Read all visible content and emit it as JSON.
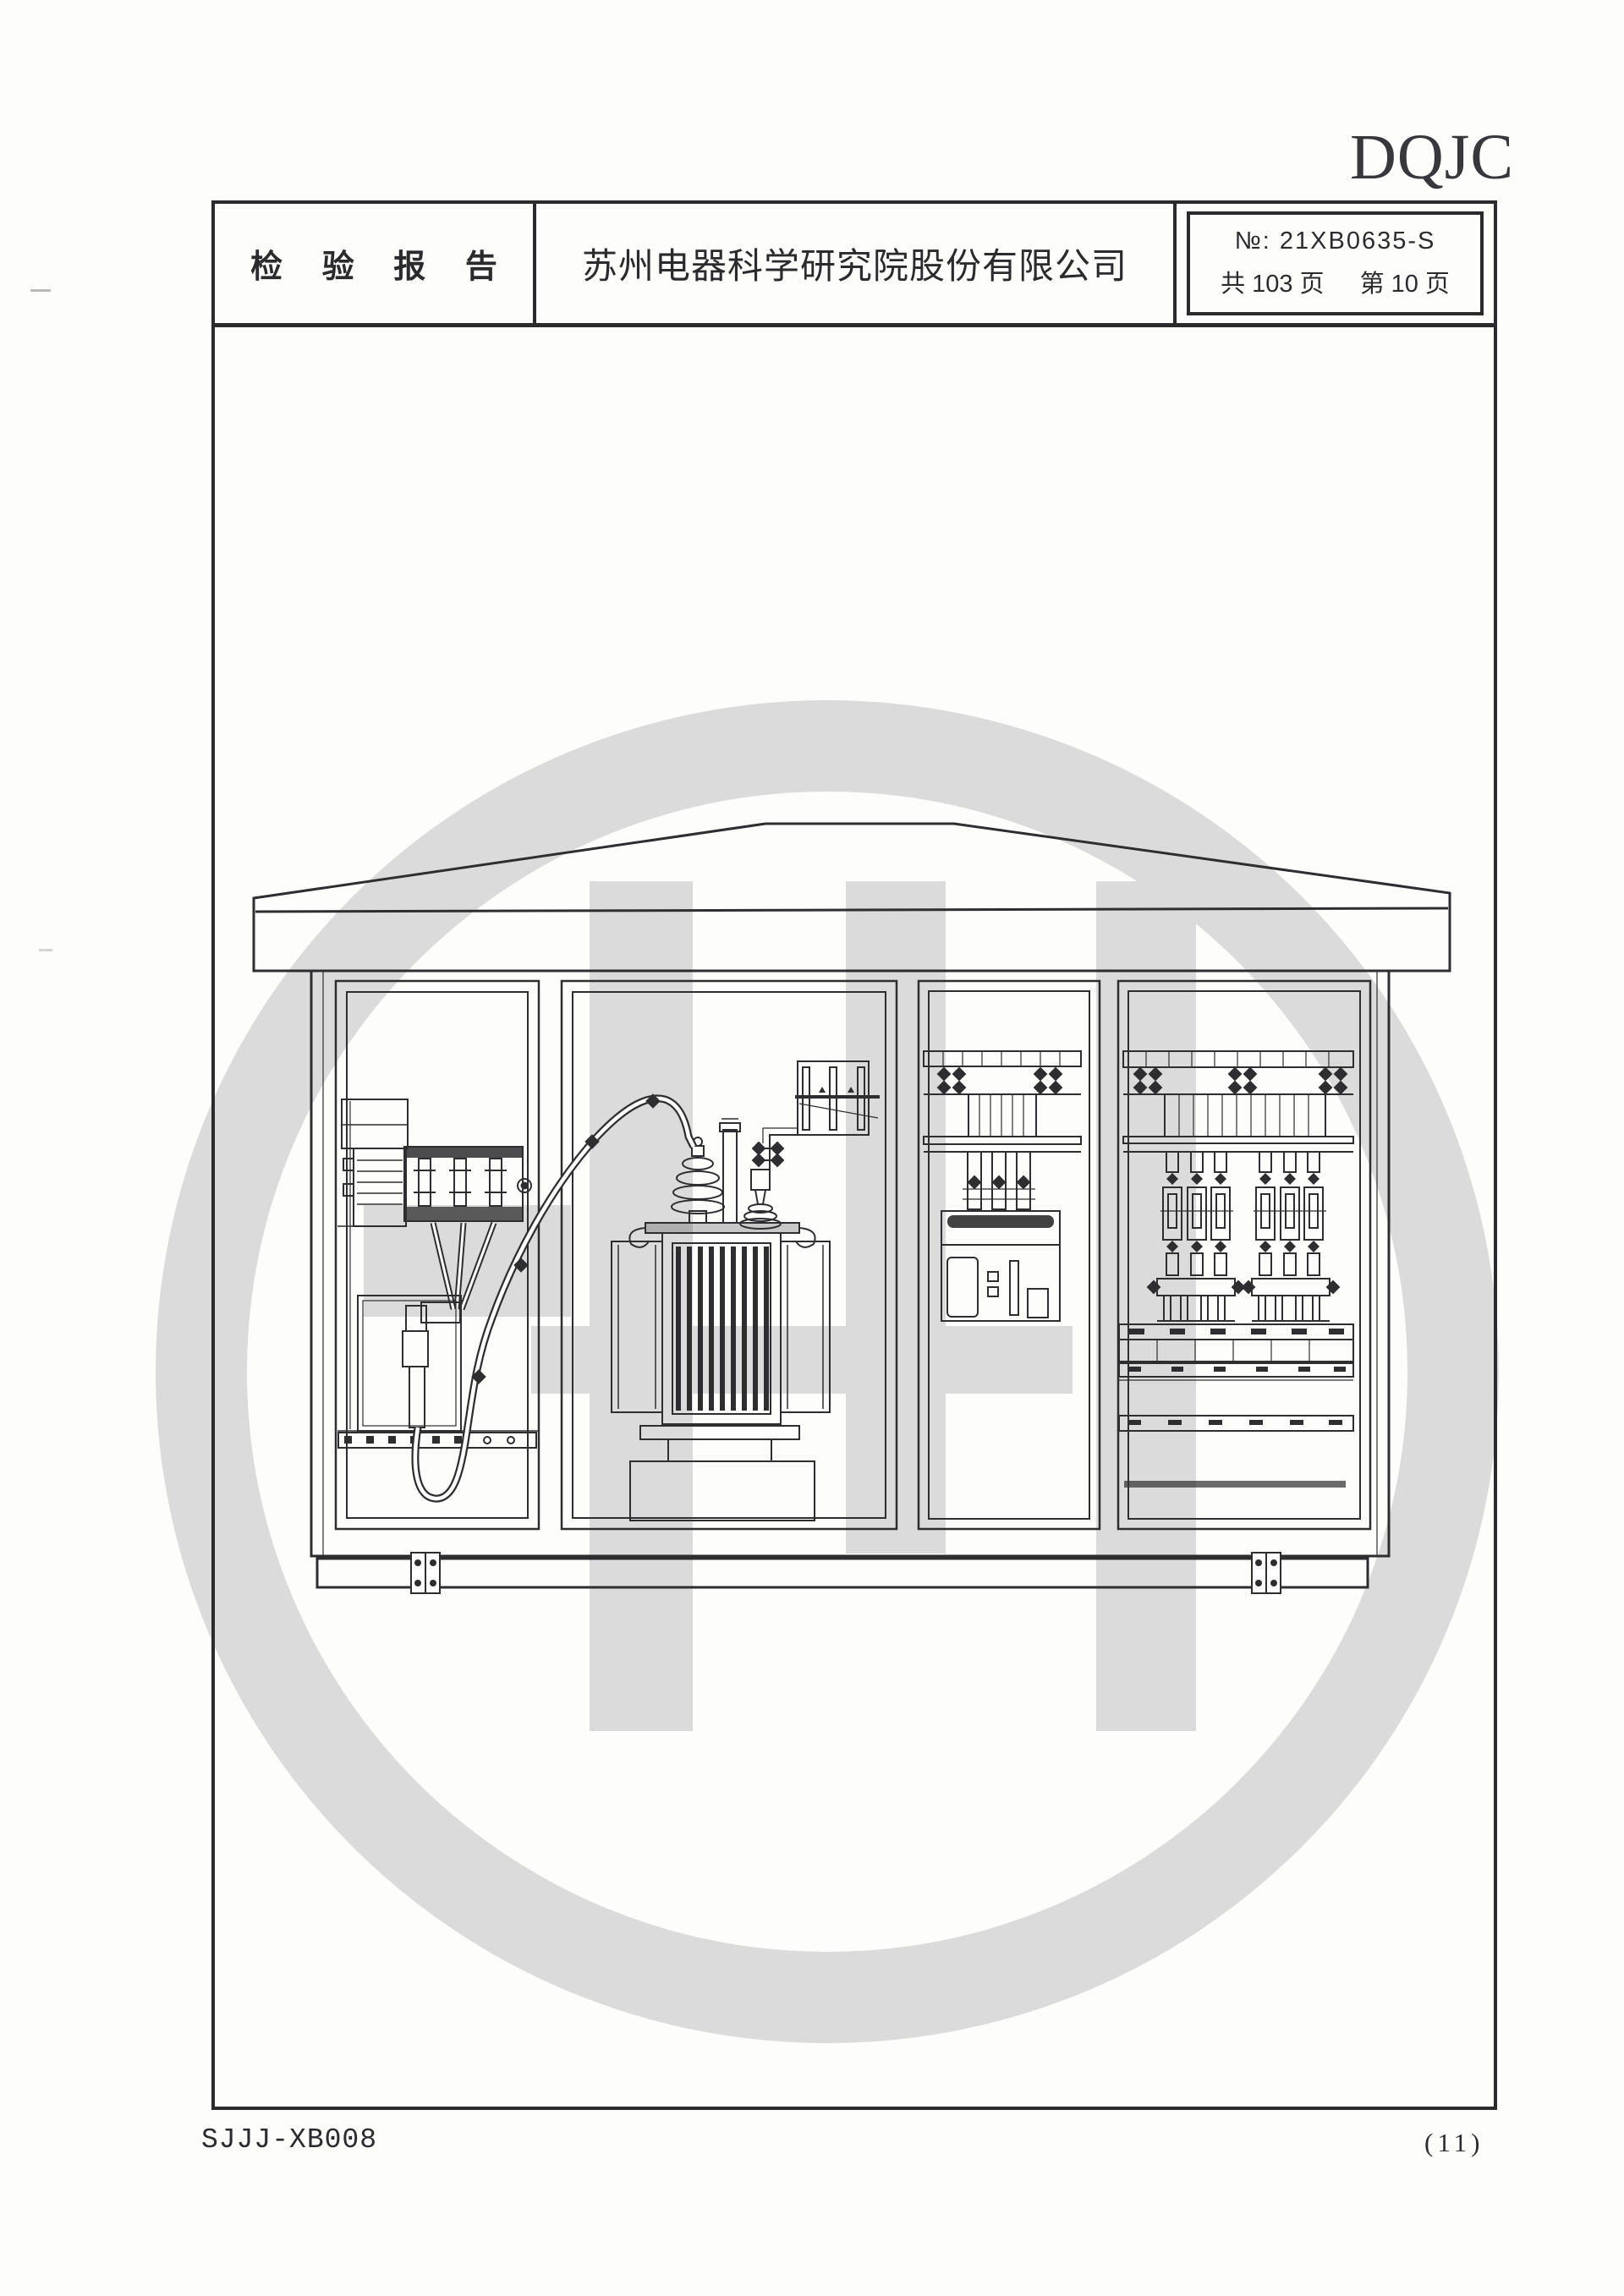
{
  "logo_text": "DQJC",
  "header": {
    "report_title": "检 验 报 告",
    "company_name": "苏州电器科学研究院股份有限公司",
    "report_no_label": "№:",
    "report_no_value": "21XB0635-S",
    "total_pages": "共 103 页",
    "current_page": "第 10 页"
  },
  "footer": {
    "doc_code": "SJJJ-XB008",
    "page_mark": "(11)"
  },
  "colors": {
    "ink": "#2e2e30",
    "watermark_gray": "#dbdbdb",
    "paper": "#fdfdfc"
  }
}
